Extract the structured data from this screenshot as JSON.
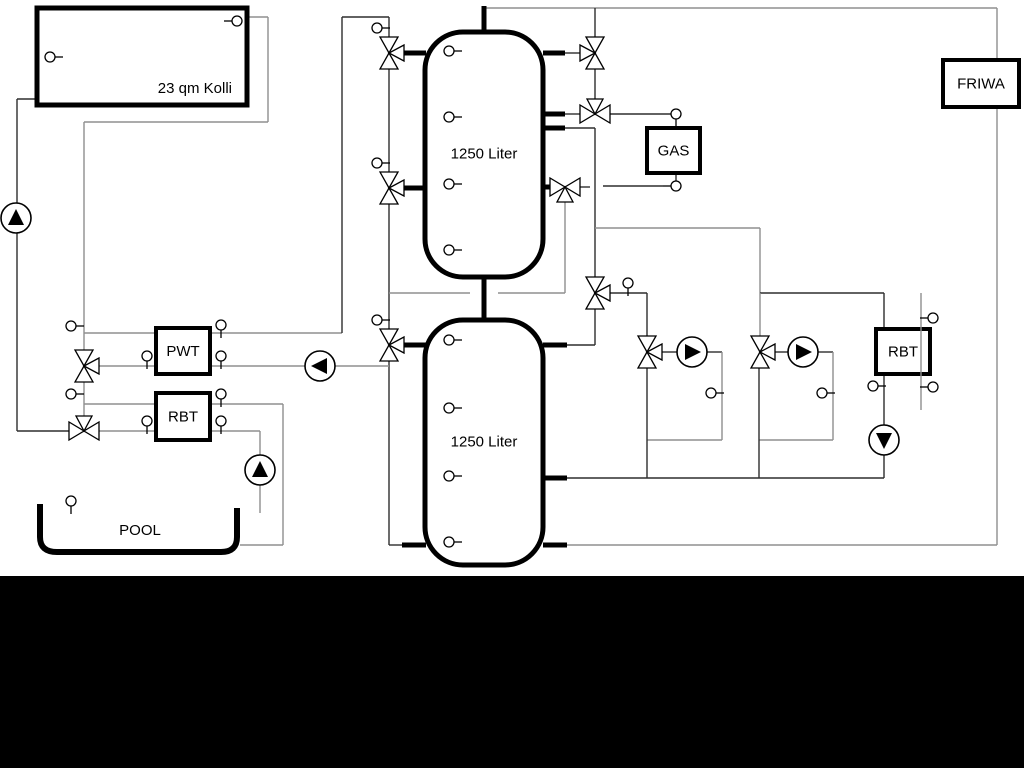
{
  "diagram": {
    "width": 1024,
    "height": 768,
    "background": "#ffffff",
    "black_band": {
      "y": 576,
      "height": 192,
      "color": "#000000"
    },
    "colors": {
      "line_dark": "#2e2e2e",
      "line_gray": "#8f8f8f",
      "component": "#000000",
      "fill": "#ffffff"
    },
    "labels": {
      "collector": "23 qm Kolli",
      "tank_upper": "1250 Liter",
      "tank_lower": "1250 Liter",
      "pwt": "PWT",
      "rbt_left": "RBT",
      "gas": "GAS",
      "friwa": "FRIWA",
      "rbt_right": "RBT",
      "pool": "POOL"
    },
    "tanks": [
      {
        "x": 425,
        "y": 32,
        "w": 118,
        "h": 245,
        "rx": 38,
        "label": "1250 Liter"
      },
      {
        "x": 425,
        "y": 320,
        "w": 118,
        "h": 245,
        "rx": 38,
        "label": "1250 Liter"
      }
    ],
    "boxes": [
      {
        "name": "collector-box",
        "x": 37,
        "y": 8,
        "w": 210,
        "h": 97,
        "lw": 5,
        "label": "23 qm Kolli",
        "lx": 232,
        "ly": 89,
        "anchor": "end"
      },
      {
        "name": "pwt-box",
        "x": 156,
        "y": 328,
        "w": 54,
        "h": 46,
        "lw": 4,
        "label": "PWT"
      },
      {
        "name": "rbt-left-box",
        "x": 156,
        "y": 393,
        "w": 54,
        "h": 47,
        "lw": 4,
        "label": "RBT"
      },
      {
        "name": "gas-box",
        "x": 647,
        "y": 128,
        "w": 53,
        "h": 45,
        "lw": 4,
        "label": "GAS"
      },
      {
        "name": "friwa-box",
        "x": 943,
        "y": 60,
        "w": 76,
        "h": 47,
        "lw": 4,
        "label": "FRIWA"
      },
      {
        "name": "rbt-right-box",
        "x": 876,
        "y": 329,
        "w": 54,
        "h": 45,
        "lw": 4,
        "label": "RBT"
      }
    ],
    "pool": {
      "d": "M 40 504 L 40 537 Q 40 552 57 552 L 221 552 Q 237 552 237 537 L 237 508",
      "label": "POOL",
      "lx": 140,
      "ly": 531
    },
    "pipes": [
      [
        37,
        99,
        17,
        99,
        "k"
      ],
      [
        17,
        99,
        17,
        431,
        "k"
      ],
      [
        17,
        431,
        69,
        431,
        "k"
      ],
      [
        247,
        17,
        268,
        17,
        "g"
      ],
      [
        268,
        17,
        268,
        122,
        "g"
      ],
      [
        268,
        122,
        84,
        122,
        "g"
      ],
      [
        84,
        122,
        84,
        333,
        "g"
      ],
      [
        84,
        333,
        342,
        333,
        "g"
      ],
      [
        342,
        333,
        342,
        17,
        "k"
      ],
      [
        342,
        17,
        389,
        17,
        "k"
      ],
      [
        389,
        17,
        389,
        37,
        "k"
      ],
      [
        389,
        69,
        389,
        172,
        "k"
      ],
      [
        389,
        204,
        389,
        329,
        "k"
      ],
      [
        389,
        361,
        389,
        545,
        "k"
      ],
      [
        389,
        545,
        404,
        545,
        "k"
      ],
      [
        335,
        366,
        389,
        366,
        "g"
      ],
      [
        210,
        366,
        305,
        366,
        "g"
      ],
      [
        99,
        366,
        156,
        366,
        "g"
      ],
      [
        84,
        333,
        84,
        350,
        "g"
      ],
      [
        84,
        382,
        84,
        404,
        "g"
      ],
      [
        84,
        404,
        156,
        404,
        "g"
      ],
      [
        84,
        404,
        84,
        416,
        "g"
      ],
      [
        99,
        431,
        156,
        431,
        "g"
      ],
      [
        210,
        404,
        283,
        404,
        "g"
      ],
      [
        283,
        404,
        283,
        545,
        "g"
      ],
      [
        283,
        545,
        240,
        545,
        "g"
      ],
      [
        210,
        431,
        260,
        431,
        "g"
      ],
      [
        260,
        431,
        260,
        513,
        "g"
      ],
      [
        484,
        8,
        997,
        8,
        "g"
      ],
      [
        997,
        8,
        997,
        545,
        "g"
      ],
      [
        997,
        545,
        567,
        545,
        "g"
      ],
      [
        595,
        8,
        595,
        37,
        "k"
      ],
      [
        595,
        69,
        595,
        99,
        "k"
      ],
      [
        565,
        53,
        580,
        53,
        "k"
      ],
      [
        565,
        114,
        580,
        114,
        "k"
      ],
      [
        610,
        114,
        671,
        114,
        "k"
      ],
      [
        676,
        173,
        676,
        181,
        "k"
      ],
      [
        663,
        186,
        603,
        186,
        "k"
      ],
      [
        580,
        187,
        590,
        187,
        "k"
      ],
      [
        565,
        128,
        595,
        128,
        "k"
      ],
      [
        595,
        128,
        595,
        277,
        "k"
      ],
      [
        595,
        228,
        760,
        228,
        "g"
      ],
      [
        760,
        228,
        760,
        293,
        "g"
      ],
      [
        760,
        293,
        884,
        293,
        "k"
      ],
      [
        760,
        293,
        760,
        336,
        "g"
      ],
      [
        565,
        202,
        565,
        293,
        "g"
      ],
      [
        565,
        293,
        498,
        293,
        "g"
      ],
      [
        470,
        293,
        389,
        293,
        "g"
      ],
      [
        610,
        293,
        647,
        293,
        "k"
      ],
      [
        647,
        293,
        647,
        336,
        "k"
      ],
      [
        595,
        309,
        595,
        345,
        "k"
      ],
      [
        595,
        345,
        567,
        345,
        "k"
      ],
      [
        662,
        352,
        677,
        352,
        "k"
      ],
      [
        707,
        352,
        722,
        352,
        "k"
      ],
      [
        722,
        352,
        722,
        440,
        "g"
      ],
      [
        722,
        440,
        647,
        440,
        "g"
      ],
      [
        647,
        368,
        647,
        478,
        "k"
      ],
      [
        775,
        352,
        788,
        352,
        "k"
      ],
      [
        818,
        352,
        833,
        352,
        "k"
      ],
      [
        833,
        352,
        833,
        440,
        "g"
      ],
      [
        833,
        440,
        759,
        440,
        "g"
      ],
      [
        759,
        368,
        759,
        478,
        "k"
      ],
      [
        567,
        478,
        884,
        478,
        "k"
      ],
      [
        884,
        293,
        884,
        329,
        "k"
      ],
      [
        884,
        374,
        884,
        425,
        "k"
      ],
      [
        884,
        455,
        884,
        478,
        "k"
      ]
    ],
    "overlay_pipes": [
      [
        921,
        293,
        921,
        410,
        "g"
      ]
    ],
    "stubs": [
      [
        404,
        53,
        426,
        53
      ],
      [
        404,
        188,
        426,
        188
      ],
      [
        404,
        345,
        426,
        345
      ],
      [
        543,
        53,
        565,
        53
      ],
      [
        543,
        114,
        565,
        114
      ],
      [
        543,
        128,
        565,
        128
      ],
      [
        543,
        187,
        551,
        187
      ],
      [
        543,
        345,
        567,
        345
      ],
      [
        543,
        478,
        567,
        478
      ],
      [
        543,
        545,
        567,
        545
      ],
      [
        402,
        545,
        426,
        545
      ],
      [
        484,
        6,
        484,
        33
      ],
      [
        484,
        275,
        484,
        322
      ]
    ],
    "valves": [
      {
        "cx": 389,
        "cy": 53,
        "t": "VE"
      },
      {
        "cx": 389,
        "cy": 188,
        "t": "VE"
      },
      {
        "cx": 389,
        "cy": 345,
        "t": "VE"
      },
      {
        "cx": 595,
        "cy": 53,
        "t": "VW"
      },
      {
        "cx": 595,
        "cy": 114,
        "t": "HN"
      },
      {
        "cx": 565,
        "cy": 187,
        "t": "HS"
      },
      {
        "cx": 595,
        "cy": 293,
        "t": "VE"
      },
      {
        "cx": 647,
        "cy": 352,
        "t": "VE"
      },
      {
        "cx": 760,
        "cy": 352,
        "t": "VE"
      },
      {
        "cx": 84,
        "cy": 366,
        "t": "VE"
      },
      {
        "cx": 84,
        "cy": 431,
        "t": "HN"
      }
    ],
    "pumps": [
      {
        "cx": 16,
        "cy": 218,
        "dir": "up"
      },
      {
        "cx": 320,
        "cy": 366,
        "dir": "left"
      },
      {
        "cx": 260,
        "cy": 470,
        "dir": "up"
      },
      {
        "cx": 692,
        "cy": 352,
        "dir": "right"
      },
      {
        "cx": 803,
        "cy": 352,
        "dir": "right"
      },
      {
        "cx": 884,
        "cy": 440,
        "dir": "down"
      }
    ],
    "sensors": [
      {
        "cx": 50,
        "cy": 57,
        "stem": "right"
      },
      {
        "cx": 237,
        "cy": 21,
        "stem": "left"
      },
      {
        "cx": 449,
        "cy": 51,
        "stem": "right"
      },
      {
        "cx": 449,
        "cy": 117,
        "stem": "right"
      },
      {
        "cx": 449,
        "cy": 184,
        "stem": "right"
      },
      {
        "cx": 449,
        "cy": 250,
        "stem": "right"
      },
      {
        "cx": 449,
        "cy": 340,
        "stem": "right"
      },
      {
        "cx": 449,
        "cy": 408,
        "stem": "right"
      },
      {
        "cx": 449,
        "cy": 476,
        "stem": "right"
      },
      {
        "cx": 449,
        "cy": 542,
        "stem": "right"
      },
      {
        "cx": 377,
        "cy": 28,
        "stem": "right"
      },
      {
        "cx": 377,
        "cy": 163,
        "stem": "right"
      },
      {
        "cx": 377,
        "cy": 320,
        "stem": "right"
      },
      {
        "cx": 71,
        "cy": 326,
        "stem": "right"
      },
      {
        "cx": 221,
        "cy": 325,
        "stem": "down"
      },
      {
        "cx": 147,
        "cy": 356,
        "stem": "down"
      },
      {
        "cx": 221,
        "cy": 356,
        "stem": "down"
      },
      {
        "cx": 71,
        "cy": 394,
        "stem": "right"
      },
      {
        "cx": 221,
        "cy": 394,
        "stem": "down"
      },
      {
        "cx": 147,
        "cy": 421,
        "stem": "down"
      },
      {
        "cx": 221,
        "cy": 421,
        "stem": "down"
      },
      {
        "cx": 71,
        "cy": 501,
        "stem": "down"
      },
      {
        "cx": 676,
        "cy": 114,
        "stem": "down"
      },
      {
        "cx": 676,
        "cy": 186,
        "stem": "left"
      },
      {
        "cx": 628,
        "cy": 283,
        "stem": "down"
      },
      {
        "cx": 711,
        "cy": 393,
        "stem": "right"
      },
      {
        "cx": 822,
        "cy": 393,
        "stem": "right"
      },
      {
        "cx": 873,
        "cy": 386,
        "stem": "right"
      },
      {
        "cx": 933,
        "cy": 318,
        "stem": "left"
      },
      {
        "cx": 933,
        "cy": 387,
        "stem": "left"
      }
    ]
  }
}
